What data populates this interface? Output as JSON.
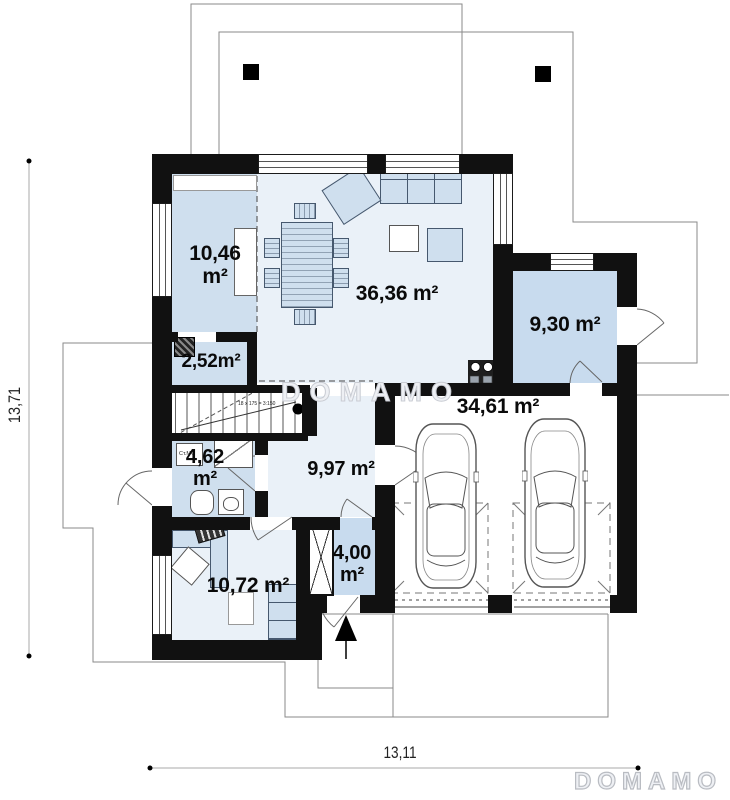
{
  "plan": {
    "watermark_center": "DOMAMO",
    "brand_logo": "DOMAMO",
    "rooms": {
      "bedroom": {
        "value": "10,46",
        "unit": "m²"
      },
      "living": {
        "label": "36,36 m²"
      },
      "pantry": {
        "label": "2,52m²"
      },
      "utility": {
        "label": "9,30 m²"
      },
      "garage": {
        "label": "34,61 m²"
      },
      "bathroom": {
        "value": "4,62",
        "unit": "m²"
      },
      "hall": {
        "label": "9,97 m²"
      },
      "vestibule": {
        "value": "4,00",
        "unit": "m²"
      },
      "study": {
        "label": "10,72 m²"
      }
    },
    "dimensions": {
      "horizontal": "13,11",
      "vertical": "13,71"
    },
    "annotations": {
      "stairs": "18 x 175 = 3:150",
      "washer": "Ст.МФ"
    },
    "colors": {
      "wall": "#111111",
      "room-blue": "#cfdfee",
      "room-pale": "#eaf1f8",
      "utility-blue": "#c8dbee",
      "furniture-line": "#46586e",
      "outline": "#8a8a8a"
    }
  }
}
